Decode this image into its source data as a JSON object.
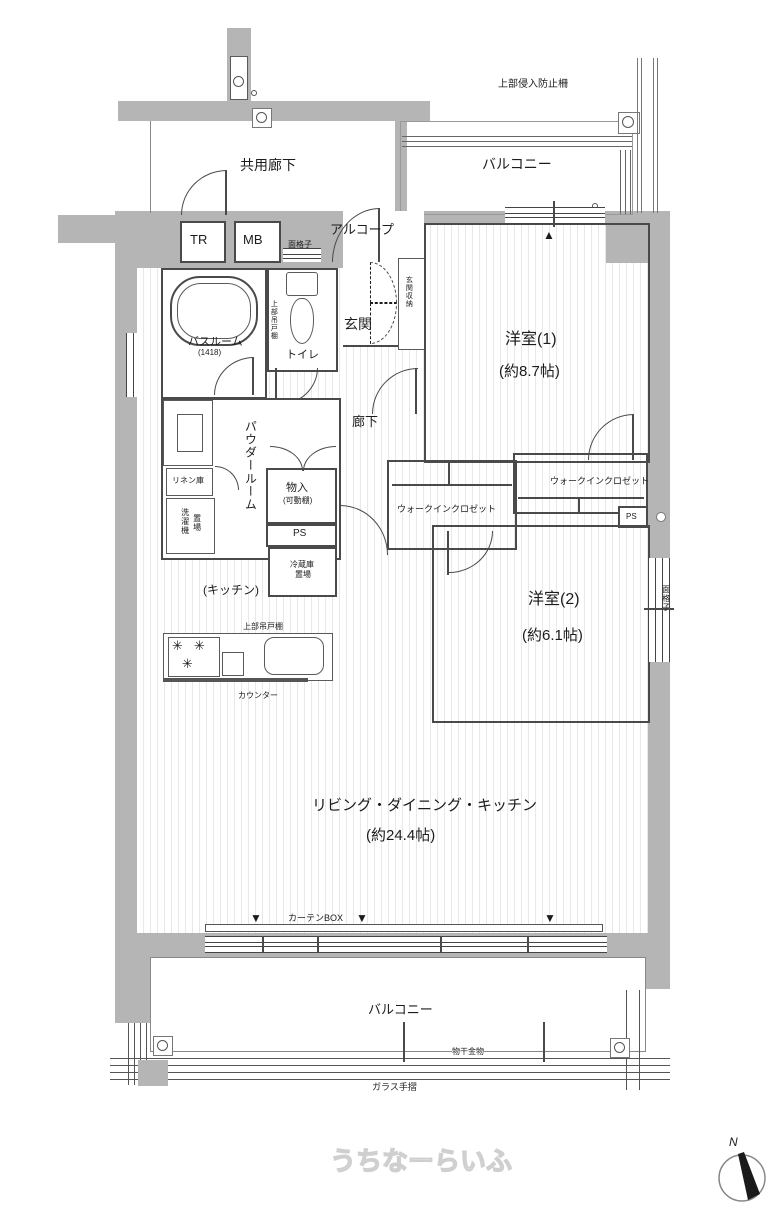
{
  "colors": {
    "wall_fill": "#b5b5b5",
    "line": "#4a4a4a",
    "floor_stripe": "#e7e7ec",
    "watermark_outline": "#cfcfcf"
  },
  "labels": {
    "intrusion_guard": "上部侵入防止柵",
    "common_corridor": "共用廊下",
    "balcony_top": "バルコニー",
    "tr": "TR",
    "mb": "MB",
    "alcove": "アルコープ",
    "lattice_toilet": "面格子",
    "entrance": "玄関",
    "entrance_storage": "玄関収納",
    "bathroom": "バスルーム",
    "bathroom_size": "(1418)",
    "toilet": "トイレ",
    "upper_cabinet_toilet": "上部吊戸棚",
    "corridor": "廊下",
    "powder_room": "パウダールーム",
    "linen": "リネン庫",
    "washer_l1": "洗濯機",
    "washer_l2": "置場",
    "monoire": "物入",
    "monoire_note": "(可動棚)",
    "ps_left": "PS",
    "fridge_l1": "冷蔵庫",
    "fridge_l2": "置場",
    "wic_left": "ウォークインクロゼット",
    "wic_right": "ウォークインクロゼット",
    "ps_right": "PS",
    "kitchen": "(キッチン)",
    "upper_cabinet_kitchen": "上部吊戸棚",
    "counter": "カウンター",
    "bedroom1": "洋室(1)",
    "bedroom1_size": "(約8.7帖)",
    "bedroom2": "洋室(2)",
    "bedroom2_size": "(約6.1帖)",
    "lattice_right": "面格子",
    "ldk": "リビング・ダイニング・キッチン",
    "ldk_size": "(約24.4帖)",
    "curtain_box": "カーテンBOX",
    "balcony_bottom": "バルコニー",
    "laundry_hardware": "物干金物",
    "glass_rail": "ガラス手摺",
    "watermark": "うちなーらいふ",
    "compass_n": "N"
  },
  "markers": {
    "up": "▲",
    "down": "▼",
    "burner": "✳"
  }
}
